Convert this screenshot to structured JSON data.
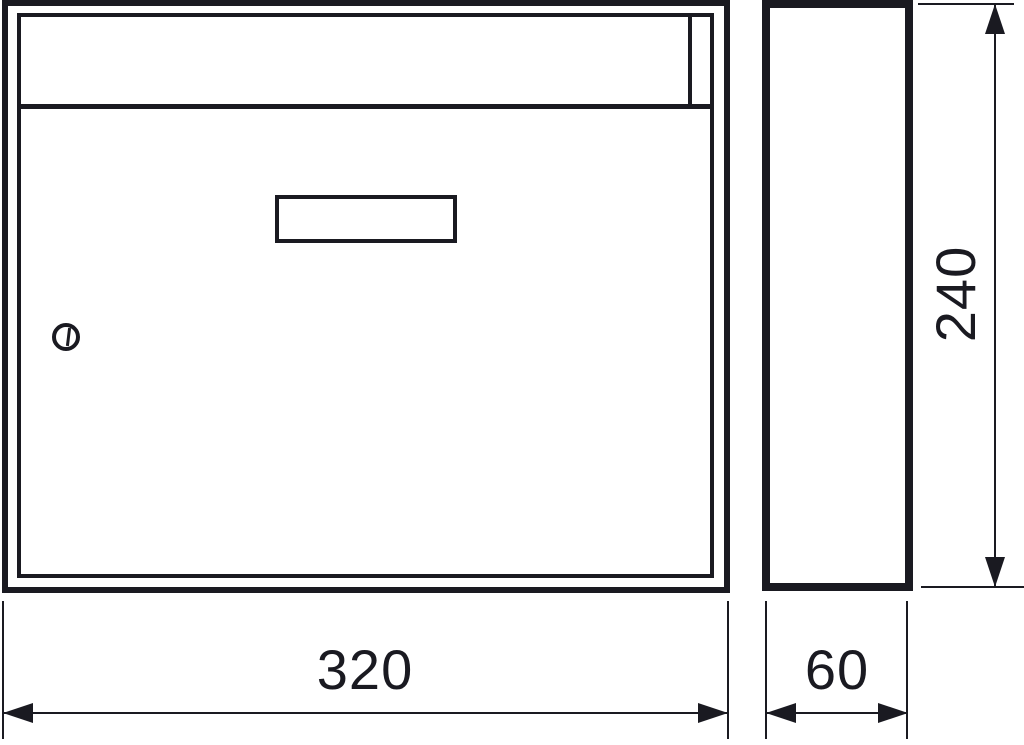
{
  "drawing": {
    "type": "technical-drawing",
    "subject": "wall-mounted mailbox, front and side orthographic views",
    "colors": {
      "line": "#1a1a21",
      "background": "#ffffff"
    },
    "views": {
      "front": {
        "name": "front-view"
      },
      "side": {
        "name": "side-view"
      }
    },
    "icons": {
      "lock": "cylinder-lock-icon"
    },
    "dimensions": {
      "width": {
        "label": "320",
        "orientation": "horizontal"
      },
      "depth": {
        "label": "60",
        "orientation": "horizontal"
      },
      "height": {
        "label": "240",
        "orientation": "vertical"
      }
    }
  }
}
